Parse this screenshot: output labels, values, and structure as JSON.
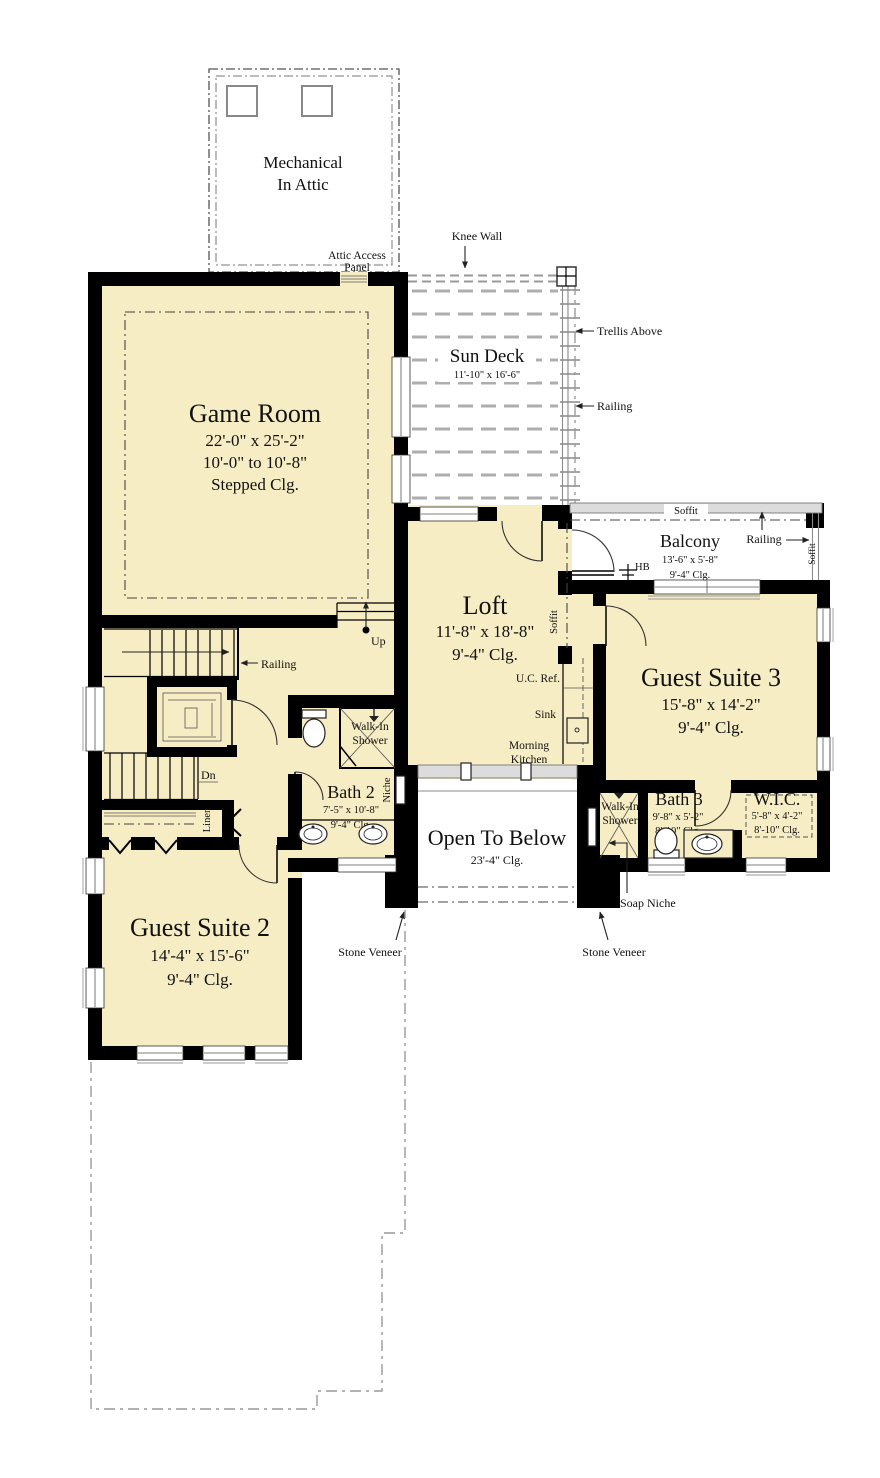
{
  "colors": {
    "floor": "#f6edc4",
    "wall": "#000000",
    "deck_line": "#aeaeae",
    "annotation": "#111111"
  },
  "rooms": {
    "mechanical": {
      "line1": "Mechanical",
      "line2": "In Attic"
    },
    "game_room": {
      "name": "Game Room",
      "dims": "22'-0\" x 25'-2\"",
      "ceiling1": "10'-0\" to 10'-8\"",
      "ceiling2": "Stepped Clg."
    },
    "sun_deck": {
      "name": "Sun Deck",
      "dims": "11'-10\" x 16'-6\""
    },
    "balcony": {
      "name": "Balcony",
      "dims": "13'-6\" x 5'-8\"",
      "ceiling": "9'-4\" Clg."
    },
    "loft": {
      "name": "Loft",
      "dims": "11'-8\" x 18'-8\"",
      "ceiling": "9'-4\" Clg."
    },
    "guest_suite_3": {
      "name": "Guest Suite 3",
      "dims": "15'-8\" x 14'-2\"",
      "ceiling": "9'-4\" Clg."
    },
    "bath_2": {
      "name": "Bath  2",
      "dims": "7'-5\" x 10'-8\"",
      "ceiling": "9'-4\" Clg."
    },
    "bath_3": {
      "name": "Bath  3",
      "dims": "9'-8\" x 5'-2\"",
      "ceiling": "8'-10\" Clg."
    },
    "wic": {
      "name": "W.I.C.",
      "dims": "5'-8\" x 4'-2\"",
      "ceiling": "8'-10\" Clg."
    },
    "guest_suite_2": {
      "name": "Guest Suite 2",
      "dims": "14'-4\" x 15'-6\"",
      "ceiling": "9'-4\" Clg."
    },
    "open_to_below": {
      "name": "Open To Below",
      "ceiling": "23'-4\" Clg."
    }
  },
  "annotations": {
    "attic_access1": "Attic Access",
    "attic_access2": "Panel",
    "knee_wall": "Knee Wall",
    "trellis": "Trellis Above",
    "railing": "Railing",
    "soffit": "Soffit",
    "hb": "HB",
    "uc_ref": "U.C. Ref.",
    "sink": "Sink",
    "morning1": "Morning",
    "morning2": "Kitchen",
    "up": "Up",
    "dn": "Dn",
    "linen": "Linen",
    "niche": "Niche",
    "walkin1": "Walk-In",
    "walkin2": "Shower",
    "soap_niche": "Soap Niche",
    "stone_veneer": "Stone Veneer"
  }
}
